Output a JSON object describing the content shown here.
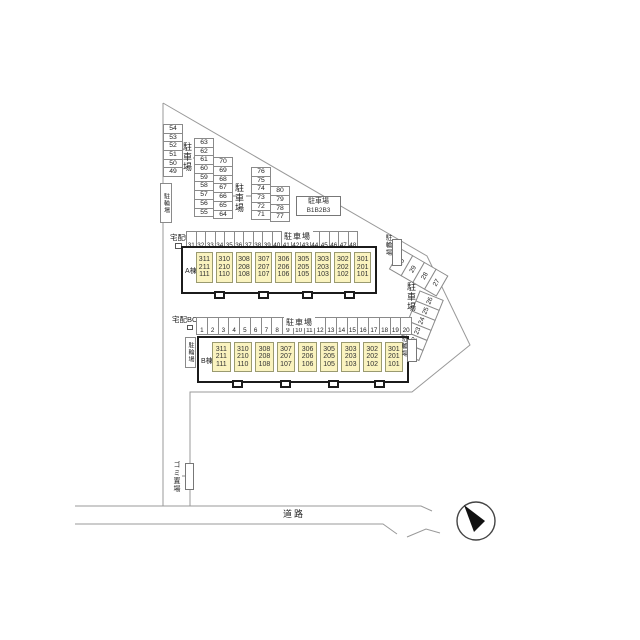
{
  "labels": {
    "delivery_box": "宅配BOX",
    "parking": "駐車場",
    "bicycle": "駐輪場",
    "road": "道路",
    "garbage": "ゴミ置場",
    "compact_parking_title": "駐車場",
    "compact_parking_numbers": "B1B2B3"
  },
  "parking": {
    "left_column": [
      "54",
      "53",
      "52",
      "51",
      "50",
      "49"
    ],
    "mid_col_a": [
      "63",
      "62",
      "61",
      "60",
      "59",
      "58",
      "57",
      "56",
      "55"
    ],
    "mid_col_b": [
      "70",
      "69",
      "68",
      "67",
      "66",
      "65",
      "64"
    ],
    "right_col_a": [
      "76",
      "75",
      "74",
      "73",
      "72",
      "71"
    ],
    "right_col_b": [
      "80",
      "79",
      "78",
      "77"
    ],
    "row_a": [
      "31",
      "32",
      "33",
      "34",
      "35",
      "36",
      "37",
      "38",
      "39",
      "40",
      "41",
      "42",
      "43",
      "44",
      "45",
      "46",
      "47",
      "48"
    ],
    "row_b": [
      "1",
      "2",
      "3",
      "4",
      "5",
      "6",
      "7",
      "8",
      "9",
      "10",
      "11",
      "12",
      "13",
      "14",
      "15",
      "16",
      "17",
      "18",
      "19",
      "20"
    ],
    "diagonal_row": [
      "30",
      "29",
      "28",
      "27"
    ],
    "slant_stack": [
      "26",
      "25",
      "24",
      "23",
      "22",
      "21"
    ]
  },
  "buildings": {
    "a": {
      "label": "A棟",
      "units": [
        [
          "311",
          "211",
          "111"
        ],
        [
          "310",
          "210",
          "110"
        ],
        [
          "308",
          "208",
          "108"
        ],
        [
          "307",
          "207",
          "107"
        ],
        [
          "306",
          "206",
          "106"
        ],
        [
          "305",
          "205",
          "105"
        ],
        [
          "303",
          "203",
          "103"
        ],
        [
          "302",
          "202",
          "102"
        ],
        [
          "301",
          "201",
          "101"
        ]
      ]
    },
    "b": {
      "label": "B棟",
      "units": [
        [
          "311",
          "211",
          "111"
        ],
        [
          "310",
          "210",
          "110"
        ],
        [
          "308",
          "208",
          "108"
        ],
        [
          "307",
          "207",
          "107"
        ],
        [
          "306",
          "206",
          "106"
        ],
        [
          "305",
          "205",
          "105"
        ],
        [
          "303",
          "203",
          "103"
        ],
        [
          "302",
          "202",
          "102"
        ],
        [
          "301",
          "201",
          "101"
        ]
      ]
    }
  },
  "colors": {
    "unit_fill": "#faf3bf",
    "line": "#8a8a8a",
    "building_outline": "#1b1b1b"
  }
}
